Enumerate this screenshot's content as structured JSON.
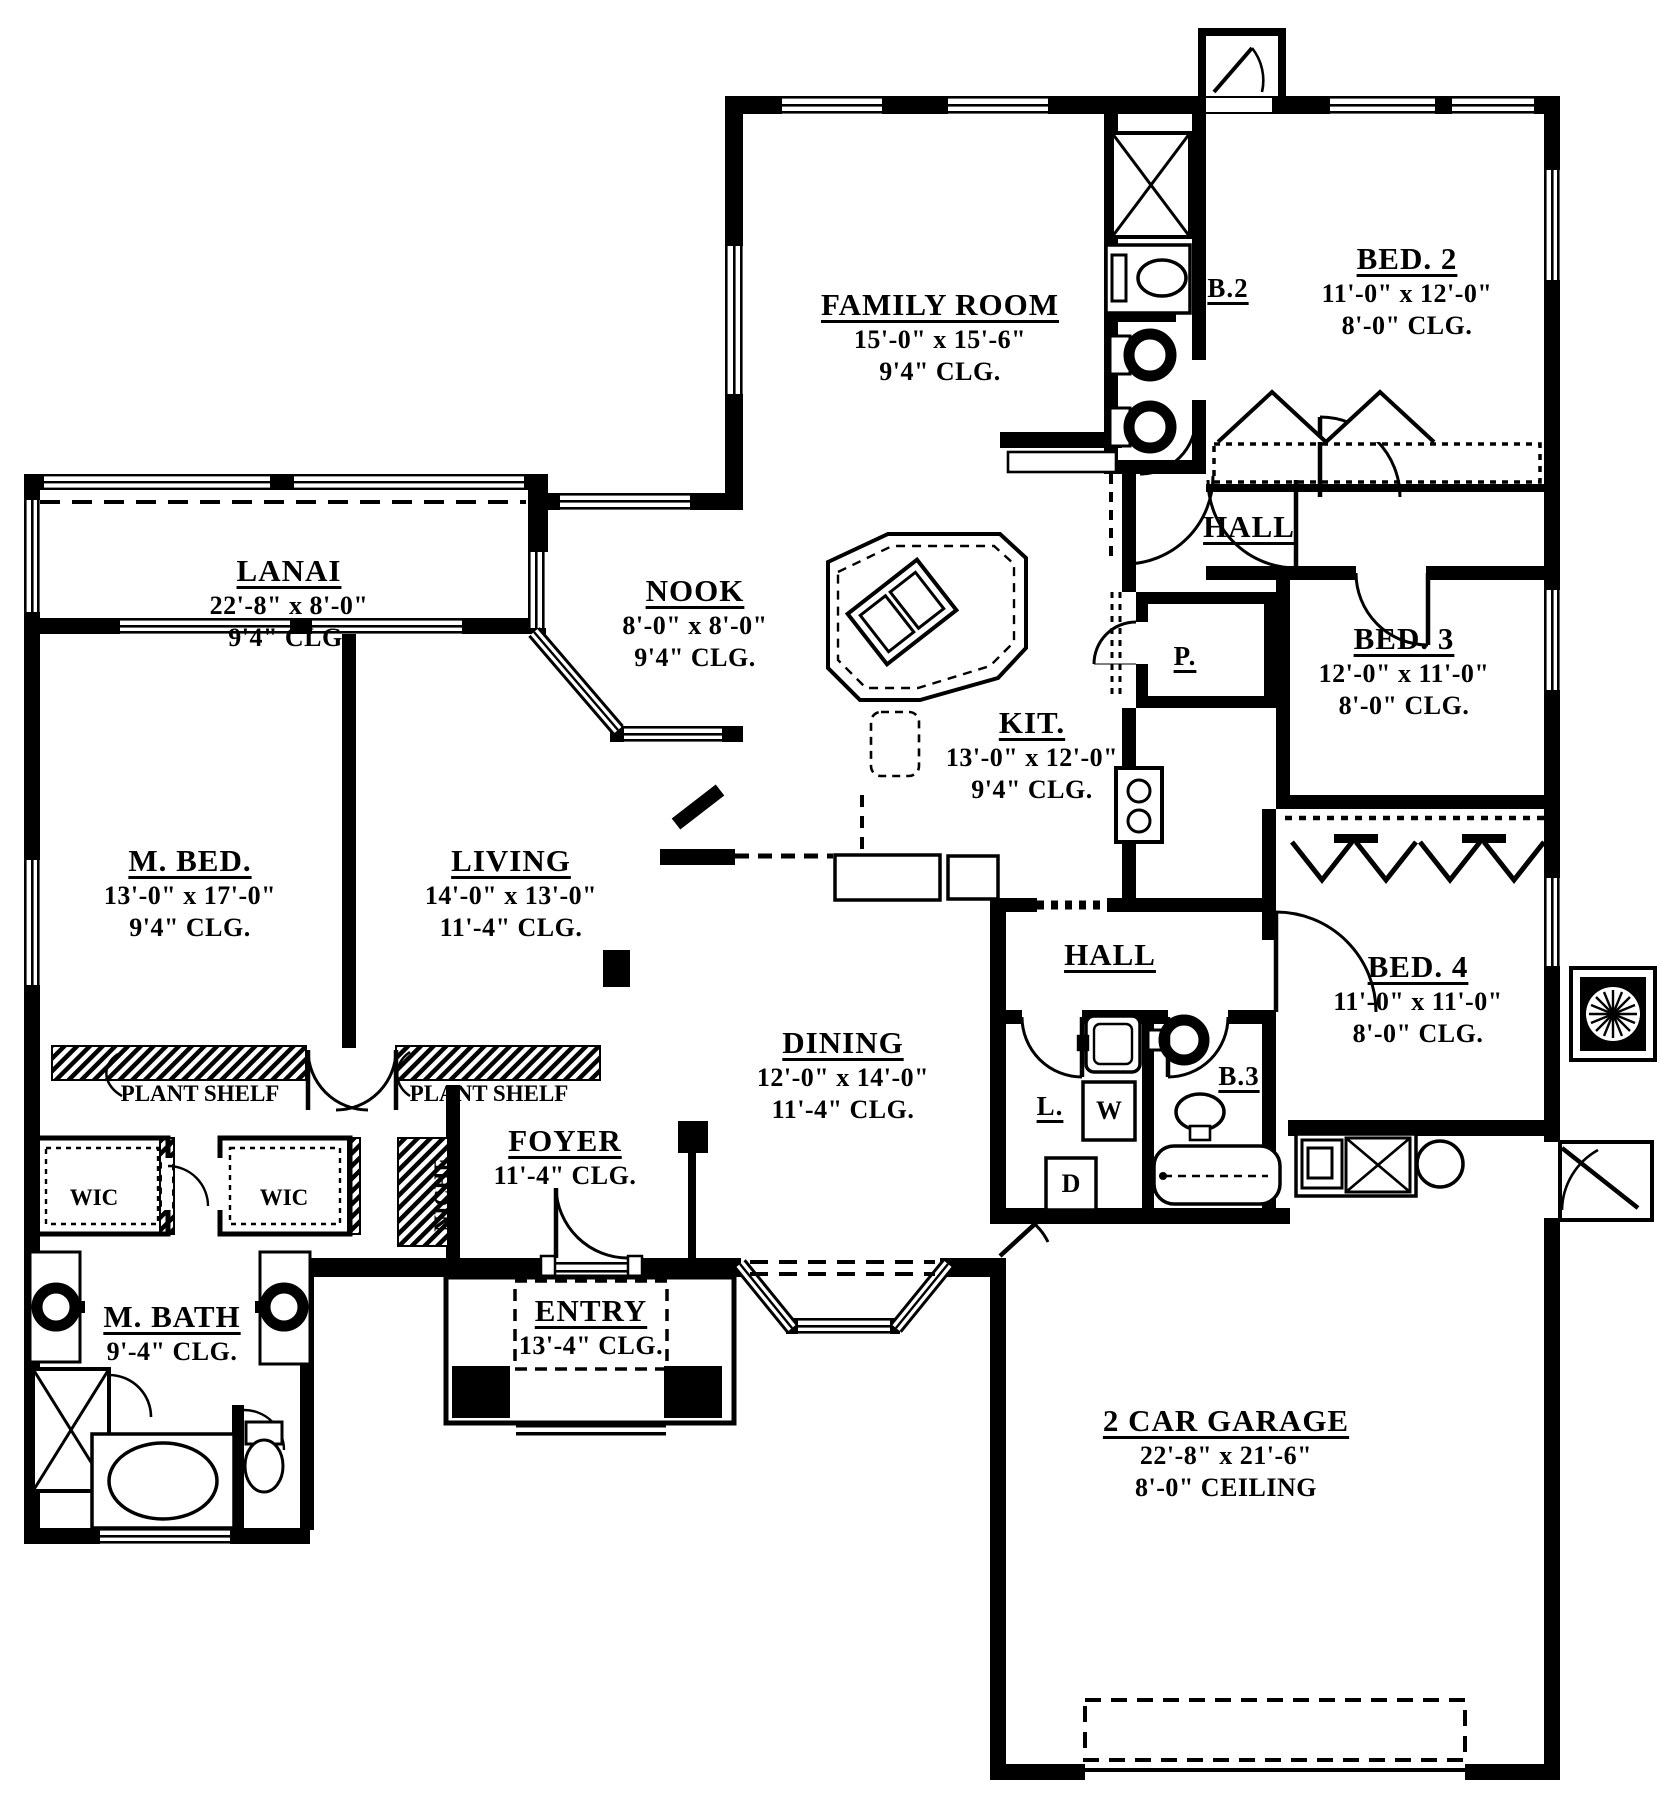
{
  "drawing": {
    "type": "architectural floor plan",
    "ink_color": "#000000",
    "paper_color": "#ffffff"
  },
  "rooms": {
    "family": {
      "name": "FAMILY ROOM",
      "dims": "15'-0\" x 15'-6\"",
      "ceiling": "9'4\" CLG."
    },
    "lanai": {
      "name": "LANAI",
      "dims": "22'-8\" x 8'-0\"",
      "ceiling": "9'4\" CLG."
    },
    "nook": {
      "name": "NOOK",
      "dims": "8'-0\" x 8'-0\"",
      "ceiling": "9'4\" CLG."
    },
    "kitchen": {
      "name": "KIT.",
      "dims": "13'-0\" x 12'-0\"",
      "ceiling": "9'4\" CLG."
    },
    "pantry": {
      "name": "P."
    },
    "bath2": {
      "name": "B.2"
    },
    "bed2": {
      "name": "BED. 2",
      "dims": "11'-0\" x 12'-0\"",
      "ceiling": "8'-0\" CLG."
    },
    "hall_upper": {
      "name": "HALL"
    },
    "bed3": {
      "name": "BED. 3",
      "dims": "12'-0\" x 11'-0\"",
      "ceiling": "8'-0\" CLG."
    },
    "mbed": {
      "name": "M. BED.",
      "dims": "13'-0\" x 17'-0\"",
      "ceiling": "9'4\" CLG."
    },
    "living": {
      "name": "LIVING",
      "dims": "14'-0\" x 13'-0\"",
      "ceiling": "11'-4\" CLG."
    },
    "dining": {
      "name": "DINING",
      "dims": "12'-0\" x 14'-0\"",
      "ceiling": "11'-4\" CLG."
    },
    "hall_lower": {
      "name": "HALL"
    },
    "bed4": {
      "name": "BED. 4",
      "dims": "11'-0\" x 11'-0\"",
      "ceiling": "8'-0\" CLG."
    },
    "laundry": {
      "name": "L."
    },
    "washer": {
      "label": "W"
    },
    "dryer": {
      "label": "D"
    },
    "bath3": {
      "name": "B.3"
    },
    "wic_left": {
      "name": "WIC"
    },
    "wic_right": {
      "name": "WIC"
    },
    "plant_shelf_left": {
      "name": "PLANT SHELF"
    },
    "plant_shelf_right": {
      "name": "PLANT SHELF"
    },
    "niche": {
      "name": "NICHE"
    },
    "foyer": {
      "name": "FOYER",
      "ceiling": "11'-4\" CLG."
    },
    "mbath": {
      "name": "M. BATH",
      "ceiling": "9'-4\" CLG."
    },
    "entry": {
      "name": "ENTRY",
      "ceiling": "13'-4\" CLG."
    },
    "garage": {
      "name": "2 CAR GARAGE",
      "dims": "22'-8\" x 21'-6\"",
      "ceiling": "8'-0\" CEILING"
    }
  }
}
